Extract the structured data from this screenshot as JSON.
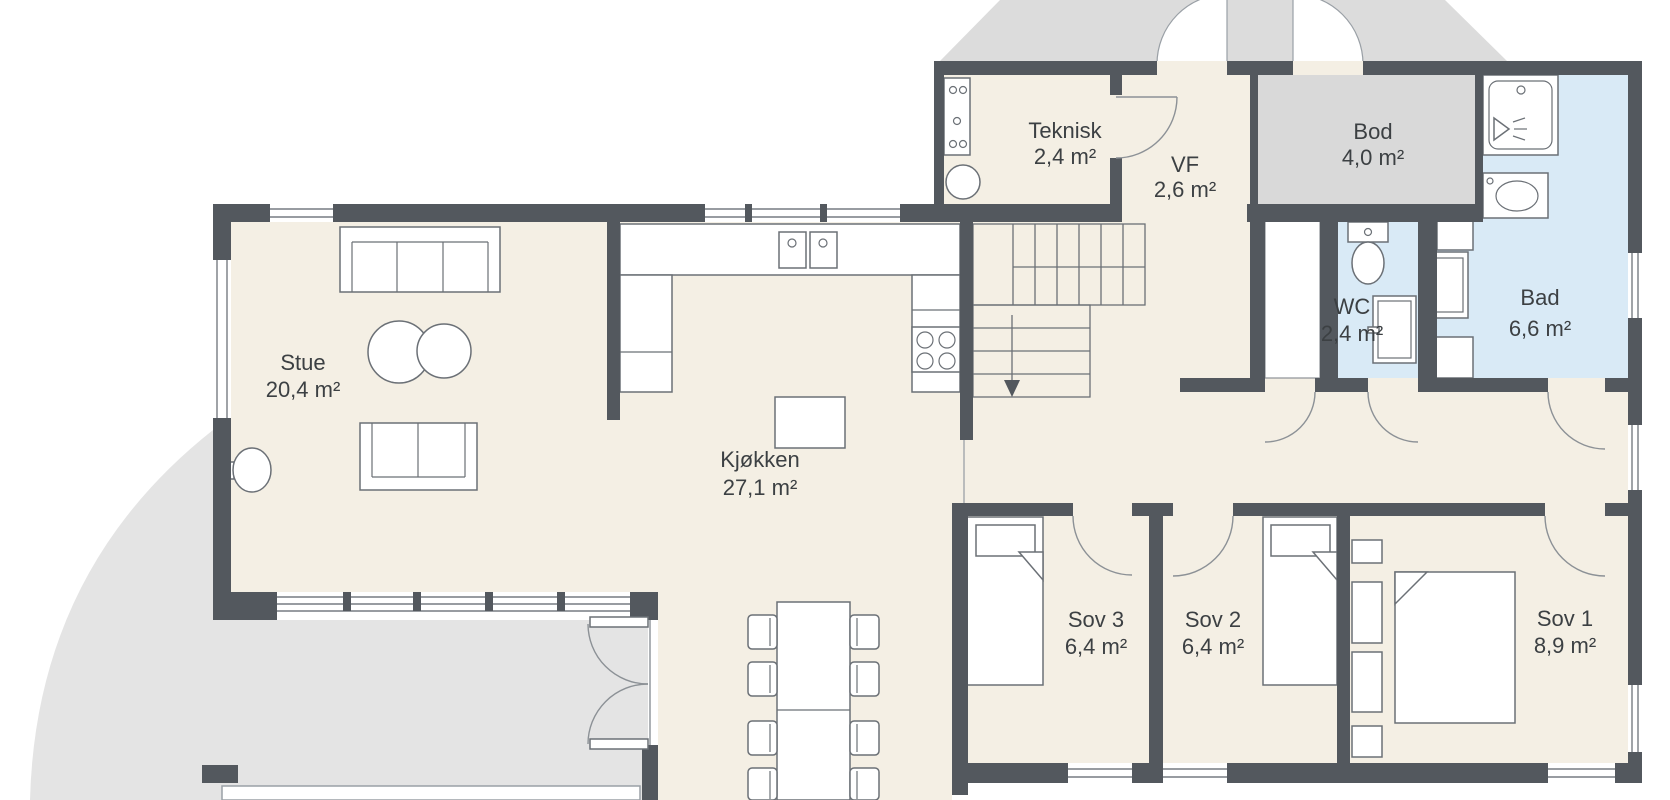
{
  "plan": {
    "type": "floor-plan",
    "language": "Norwegian",
    "rooms": {
      "stue": {
        "name": "Stue",
        "area": "20,4 m²"
      },
      "kjokken": {
        "name": "Kjøkken",
        "area": "27,1 m²"
      },
      "teknisk": {
        "name": "Teknisk",
        "area": "2,4 m²"
      },
      "vf": {
        "name": "VF",
        "area": "2,6 m²"
      },
      "bod": {
        "name": "Bod",
        "area": "4,0 m²"
      },
      "wc": {
        "name": "WC",
        "area": "2,4 m²"
      },
      "bad": {
        "name": "Bad",
        "area": "6,6 m²"
      },
      "sov3": {
        "name": "Sov 3",
        "area": "6,4 m²"
      },
      "sov2": {
        "name": "Sov 2",
        "area": "6,4 m²"
      },
      "sov1": {
        "name": "Sov 1",
        "area": "8,9 m²"
      }
    },
    "colors": {
      "wall": "#53585e",
      "floor_beige": "#f4efe4",
      "wet_room_blue": "#d9eaf6",
      "storage_gray": "#d9d9d9",
      "terrace_gray": "#e4e4e4",
      "porch_gray": "#dcdcdc",
      "outline_gray": "#6b7076",
      "text": "#3c4043",
      "background": "#ffffff"
    },
    "furniture_icons": [
      "sofa-icon",
      "loveseat-icon",
      "coffee-tables-icon",
      "side-table-icon",
      "kitchen-counter-icon",
      "sink-icon",
      "stove-icon",
      "kitchen-island-icon",
      "dining-table-icon",
      "chair-icon",
      "stairs-icon",
      "bed-single-icon",
      "bed-double-icon",
      "wardrobe-icon",
      "toilet-icon",
      "bathtub-icon",
      "shower-icon",
      "vanity-icon",
      "washer-icon",
      "boiler-icon",
      "electrical-panel-icon",
      "door-swing-icon",
      "window-icon"
    ]
  }
}
